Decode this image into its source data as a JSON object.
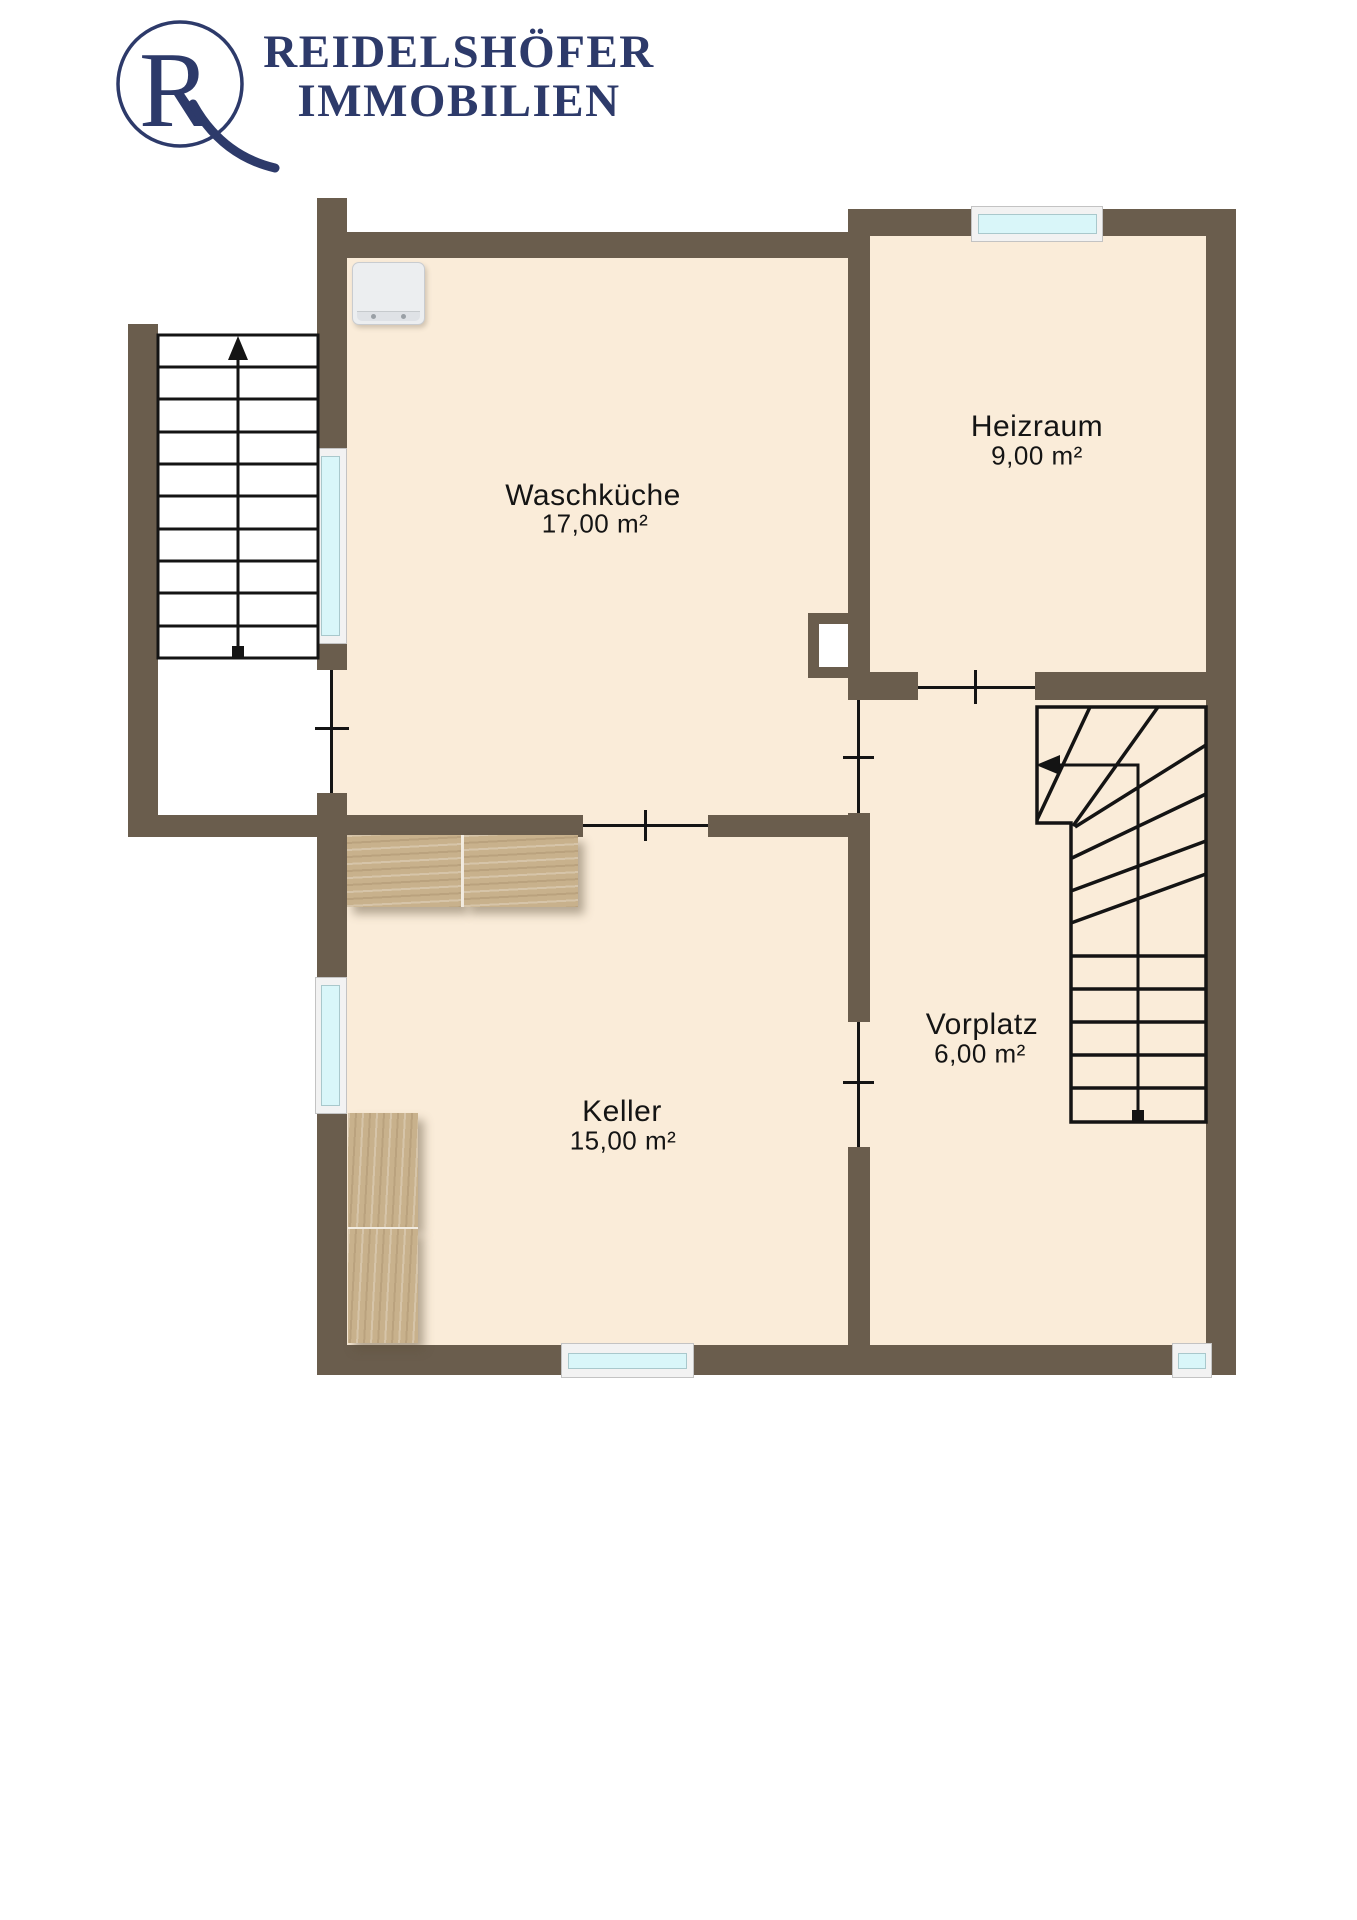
{
  "brand": {
    "monogram": "R",
    "line1": "REIDELSHÖFER",
    "line2": "IMMOBILIEN"
  },
  "floorplan": {
    "level": "basement",
    "rooms": [
      {
        "name": "Waschküche",
        "area": "17,00 m²"
      },
      {
        "name": "Heizraum",
        "area": "9,00 m²"
      },
      {
        "name": "Keller",
        "area": "15,00 m²"
      },
      {
        "name": "Vorplatz",
        "area": "6,00 m²"
      }
    ],
    "stairs": [
      {
        "id": "exterior-stair",
        "treads": 10,
        "direction_arrow": "up"
      },
      {
        "id": "interior-winder-stair",
        "straight_treads": 6,
        "winder_treads": 6,
        "direction_arrow": "left"
      }
    ],
    "windows": 5,
    "doors": 5
  },
  "colors": {
    "wall": "#6A5D4D",
    "floor": "#FAECD9",
    "window_glass": "#D9F6F9",
    "window_frame": "#F2F2F2",
    "stair_line": "#141414",
    "wood_furniture": "#C8B18C",
    "appliance": "#ECEEF0",
    "brand_navy": "#2D3A6A",
    "background": "#FFFFFF"
  }
}
